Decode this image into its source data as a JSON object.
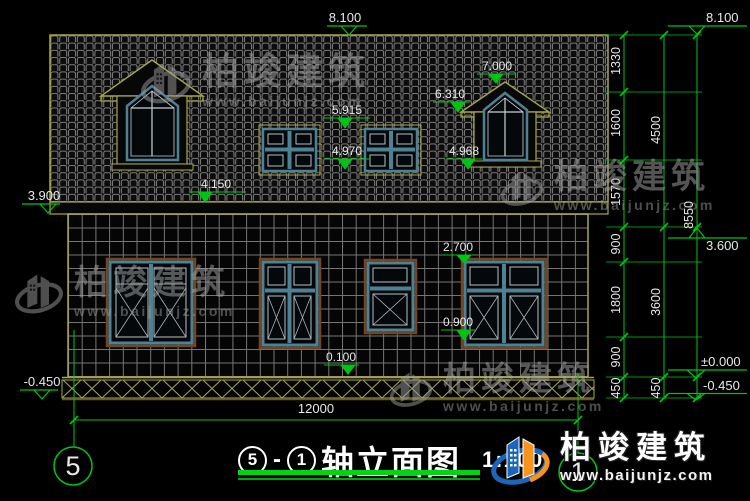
{
  "levels": {
    "ridge": "8.100",
    "ridge_right": "8.100",
    "dormer_apex": "7.000",
    "dormer_eave": "6.310",
    "attic_win_head": "5.915",
    "attic_win_sill": "4.970",
    "dormer_base": "4.968",
    "roof_eave": "4.150",
    "eave_wall_top": "3.900",
    "floor2": "3.600",
    "win_head": "2.700",
    "win_sill": "0.900",
    "plinth": "0.100",
    "zero": "±0.000",
    "ground_left": "-0.450",
    "ground_right": "-0.450"
  },
  "dims": {
    "chain_inner": [
      "1330",
      "1600",
      "1570",
      "900",
      "1800",
      "900",
      "450"
    ],
    "chain_outer": [
      "4500",
      "3600",
      "450"
    ],
    "total": "8550",
    "width": "12000"
  },
  "axes": {
    "left": "5",
    "right": "1"
  },
  "titleblock": {
    "axis_start": "5",
    "dash": "-",
    "axis_end": "1",
    "name": "轴立面图",
    "scale": "1:100"
  },
  "watermark": {
    "brand": "柏竣建筑",
    "url": "www.baijunjz.com"
  },
  "logo": {
    "brand": "柏竣建筑",
    "url": "www.baijunjz.com"
  },
  "colors": {
    "dim_green": "#00c414",
    "outline_olive": "#a8a848",
    "window_teal": "#4d8294",
    "sill_brown": "#74451f",
    "logo_blue": "#1a66bb",
    "logo_orange": "#f7941d"
  }
}
